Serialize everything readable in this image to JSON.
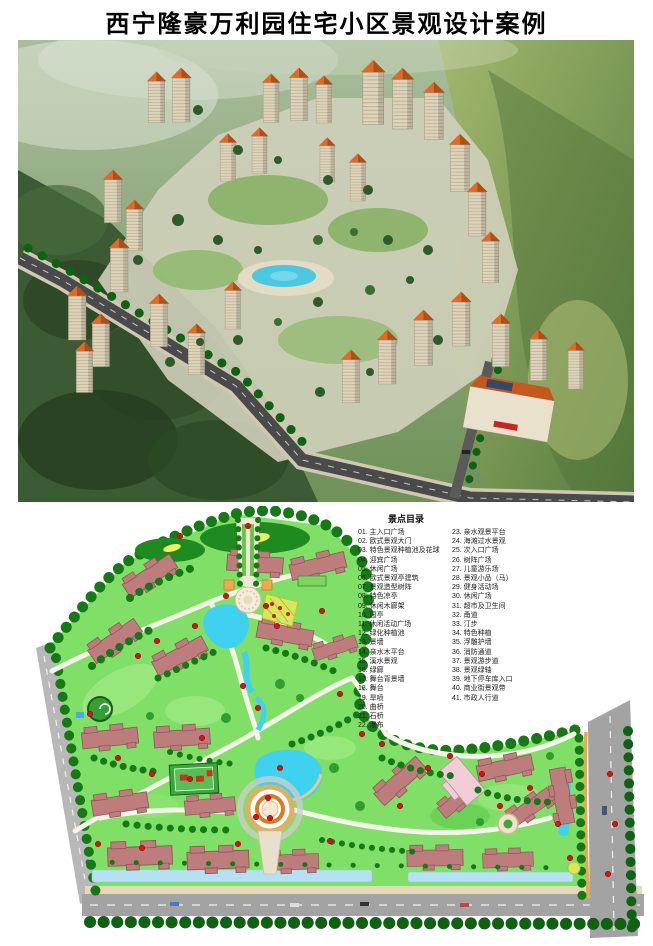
{
  "page": {
    "title": "西宁隆豪万利园住宅小区景观设计案例"
  },
  "site_plan": {
    "legend": {
      "header": "景点目录",
      "column1": [
        "01. 主入口广场",
        "02. 欧式景观大门",
        "03. 特色景观种植池及花球",
        "04. 迎宾广场",
        "05. 休闲广场",
        "06. 欧式景观亭建筑",
        "07. 景观造型树阵",
        "08. 特色凉亭",
        "09. 休闲木廊架",
        "10. 园亭",
        "11. 休闲活动广场",
        "12. 绿化种植池",
        "13. 景墙",
        "14. 亲水木平台",
        "15. 溪水景观",
        "16. 绿廊",
        "17. 舞台背景墙",
        "18. 舞台",
        "19. 旱喷",
        "20. 曲桥",
        "21. 石桥",
        "22. 瀑布"
      ],
      "column2": [
        "23. 亲水观景平台",
        "24. 海滩过水景观",
        "25. 次入口广场",
        "26. 树阵广场",
        "27. 儿童游乐场",
        "28. 景观小品（马）",
        "29. 健身活动场",
        "30. 休闲广场",
        "31. 超市及卫生间",
        "32. 甬道",
        "33. 汀步",
        "34. 特色种植",
        "35. 浮雕护墙",
        "36. 消防通道",
        "37. 景观游步道",
        "38. 景观绿轴",
        "39. 地下停车库入口",
        "40. 商业街景观带",
        "41. 市政人行道"
      ]
    },
    "colors": {
      "ground_green": "#7fdf66",
      "tree_green": "#157a15",
      "building_rose": "#bd7d7d",
      "water_cyan": "#3ed2f0",
      "road_gray": "#a3a3a3",
      "marker_red": "#cf1515",
      "fountain_orange": "#e08030",
      "special_building_pink": "#f2cdd8"
    }
  },
  "aerial_view": {
    "colors": {
      "roof_orange": "#cf5c1e",
      "facade_beige": "#ded4bc",
      "hill_green": "#6b8f55",
      "forest_dark": "#3c5a33",
      "pond_cyan": "#49c8e0",
      "road_dark": "#4a4a4a"
    }
  }
}
